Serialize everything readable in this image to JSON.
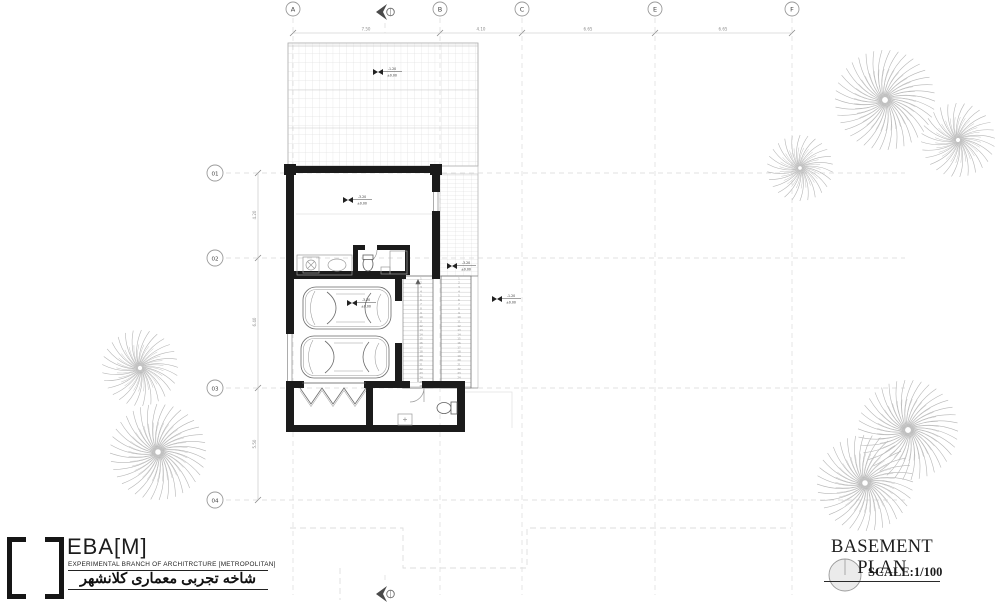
{
  "title_block": {
    "title": "BASEMENT PLAN",
    "scale_label": "SCALE:1/100"
  },
  "logo": {
    "bracket_left": "[",
    "bracket_right": "]",
    "name": "EBA[M]",
    "subtitle": "EXPERIMENTAL BRANCH OF ARCHITRCTURE [METROPOLITAN]",
    "persian_title": "شاخه تجربی معماری کلانشهر"
  },
  "grid": {
    "columns": [
      {
        "label": "A",
        "x": 293
      },
      {
        "label": "B",
        "x": 440
      },
      {
        "label": "C",
        "x": 522
      },
      {
        "label": "E",
        "x": 655
      },
      {
        "label": "F",
        "x": 792
      }
    ],
    "rows": [
      {
        "label": "01",
        "y": 173
      },
      {
        "label": "02",
        "y": 258
      },
      {
        "label": "03",
        "y": 388
      },
      {
        "label": "04",
        "y": 500
      }
    ]
  },
  "dimensions": {
    "top": [
      {
        "x": 366,
        "label": "7.50"
      },
      {
        "x": 481,
        "label": "4.10"
      },
      {
        "x": 588,
        "label": "6.65"
      },
      {
        "x": 723,
        "label": "6.65"
      }
    ],
    "left": [
      {
        "y": 215,
        "label": "4.20"
      },
      {
        "y": 322,
        "label": "6.40"
      },
      {
        "y": 444,
        "label": "5.50"
      }
    ]
  },
  "levels": [
    {
      "name": "courtyard",
      "x": 378,
      "y": 72,
      "a": "-1.20",
      "b": "±0.00"
    },
    {
      "name": "main-room",
      "x": 348,
      "y": 200,
      "a": "-3.20",
      "b": "±0.00"
    },
    {
      "name": "garage",
      "x": 352,
      "y": 303,
      "a": "-3.20",
      "b": "±0.00"
    },
    {
      "name": "stair-landing",
      "x": 452,
      "y": 266,
      "a": "-3.20",
      "b": "±0.00"
    },
    {
      "name": "east-terrace",
      "x": 497,
      "y": 299,
      "a": "-1.20",
      "b": "±0.00"
    }
  ],
  "stairs": {
    "flights": [
      {
        "x": 403,
        "y": 276,
        "w": 30,
        "h": 112,
        "treads": 26
      },
      {
        "x": 441,
        "y": 276,
        "w": 30,
        "h": 112,
        "treads": 26
      }
    ]
  },
  "trees": [
    {
      "x": 885,
      "y": 100,
      "r": 50
    },
    {
      "x": 958,
      "y": 140,
      "r": 37
    },
    {
      "x": 800,
      "y": 168,
      "r": 33
    },
    {
      "x": 140,
      "y": 368,
      "r": 38
    },
    {
      "x": 158,
      "y": 452,
      "r": 48
    },
    {
      "x": 908,
      "y": 430,
      "r": 50
    },
    {
      "x": 865,
      "y": 483,
      "r": 48
    }
  ],
  "colors": {
    "wall": "#1b1b1b",
    "grid_line": "#d9d9d9",
    "tile_line": "#d6d6d6",
    "tree_stroke": "#b6b6b6",
    "north_arrow": "#4a4a4a"
  }
}
